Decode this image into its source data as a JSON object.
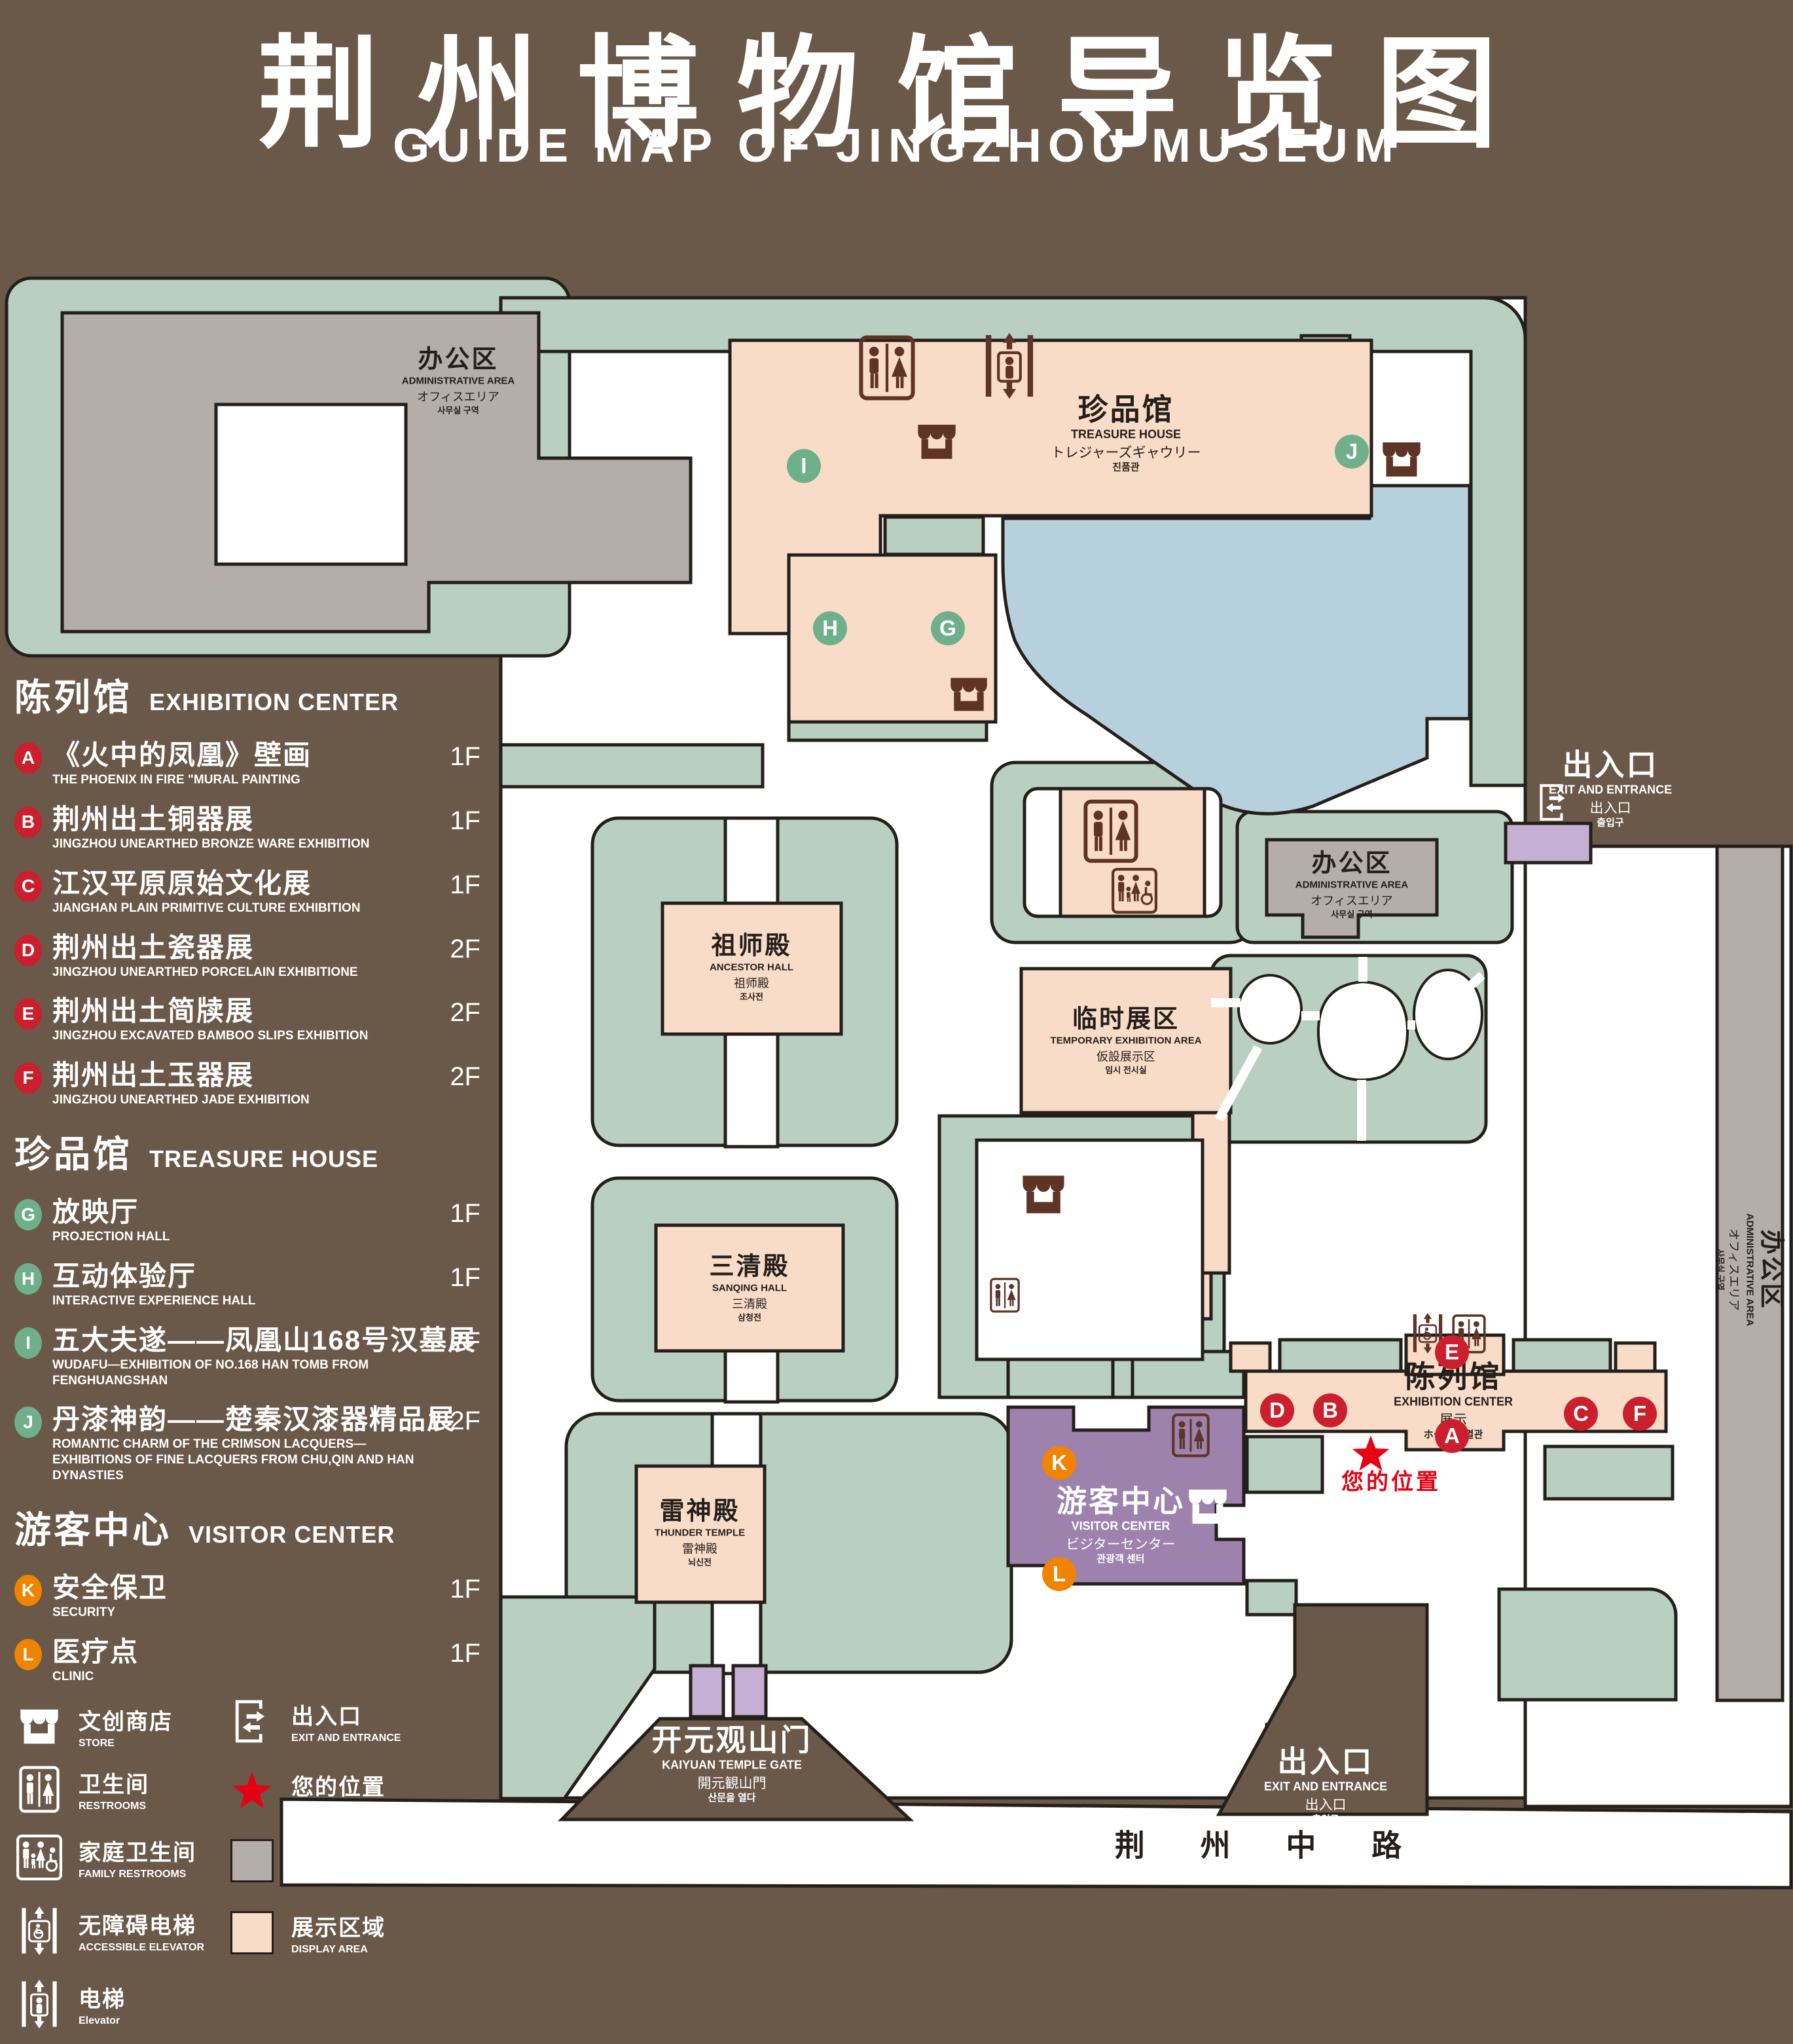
{
  "title": {
    "zh": "荆州博物馆导览图",
    "en": "GUIDE MAP OF JINGZHOU MUSEUM"
  },
  "legend": {
    "sections": [
      {
        "zh": "陈列馆",
        "en": "EXHIBITION CENTER",
        "color": "#cc1f2d",
        "items": [
          {
            "key": "A",
            "zh": "《火中的凤凰》壁画",
            "en": "THE PHOENIX IN FIRE \"MURAL PAINTING",
            "floor": "1F"
          },
          {
            "key": "B",
            "zh": "荆州出土铜器展",
            "en": "JINGZHOU UNEARTHED BRONZE WARE EXHIBITION",
            "floor": "1F"
          },
          {
            "key": "C",
            "zh": "江汉平原原始文化展",
            "en": "JIANGHAN PLAIN PRIMITIVE CULTURE EXHIBITION",
            "floor": "1F"
          },
          {
            "key": "D",
            "zh": "荆州出土瓷器展",
            "en": "JINGZHOU UNEARTHED PORCELAIN EXHIBITIONE",
            "floor": "2F"
          },
          {
            "key": "E",
            "zh": "荆州出土简牍展",
            "en": "JINGZHOU EXCAVATED BAMBOO SLIPS EXHIBITION",
            "floor": "2F"
          },
          {
            "key": "F",
            "zh": "荆州出土玉器展",
            "en": "JINGZHOU UNEARTHED JADE EXHIBITION",
            "floor": "2F"
          }
        ]
      },
      {
        "zh": "珍品馆",
        "en": "TREASURE HOUSE",
        "color": "#6fb08a",
        "items": [
          {
            "key": "G",
            "zh": "放映厅",
            "en": "PROJECTION HALL",
            "floor": "1F"
          },
          {
            "key": "H",
            "zh": "互动体验厅",
            "en": "INTERACTIVE EXPERIENCE HALL",
            "floor": "1F"
          },
          {
            "key": "I",
            "zh": "五大夫遂——凤凰山168号汉墓展",
            "en": "WUDAFU—EXHIBITION OF NO.168 HAN TOMB FROM FENGHUANGSHAN",
            "floor": "2F"
          },
          {
            "key": "J",
            "zh": "丹漆神韵——楚秦汉漆器精品展",
            "en": "ROMANTIC CHARM OF THE CRIMSON LACQUERS—EXHIBITIONS OF FINE LACQUERS FROM CHU,QIN AND HAN DYNASTIES",
            "floor": "1-2F"
          }
        ]
      },
      {
        "zh": "游客中心",
        "en": "VISITOR CENTER",
        "color": "#f08300",
        "items": [
          {
            "key": "K",
            "zh": "安全保卫",
            "en": "SECURITY",
            "floor": "1F"
          },
          {
            "key": "L",
            "zh": "医疗点",
            "en": "CLINIC",
            "floor": "1F"
          }
        ]
      }
    ],
    "symbols": [
      {
        "icon": "store-icon",
        "zh": "文创商店",
        "en": "STORE"
      },
      {
        "icon": "exit-icon",
        "zh": "出入口",
        "en": "EXIT AND ENTRANCE"
      },
      {
        "icon": "restroom-icon",
        "zh": "卫生间",
        "en": "RESTROOMS"
      },
      {
        "icon": "location-star-icon",
        "zh": "您的位置",
        "en": "YOUR LOCATION"
      },
      {
        "icon": "family-restroom-icon",
        "zh": "家庭卫生间",
        "en": "FAMILY RESTROOMS"
      },
      {
        "icon": "office-swatch",
        "zh": "办公区域",
        "en": "OFFICE AREA"
      },
      {
        "icon": "accessible-elevator-icon",
        "zh": "无障碍电梯",
        "en": "ACCESSIBLE ELEVATOR"
      },
      {
        "icon": "display-swatch",
        "zh": "展示区域",
        "en": "DISPLAY AREA"
      },
      {
        "icon": "elevator-icon",
        "zh": "电梯",
        "en": "Elevator"
      }
    ]
  },
  "map": {
    "labels": {
      "admin": {
        "zh": "办公区",
        "en": "ADMINISTRATIVE AREA",
        "jp": "オフィスエリア",
        "kr": "사무실 구역"
      },
      "treasure": {
        "zh": "珍品馆",
        "en": "TREASURE HOUSE",
        "jp": "トレジャーズギャウリー",
        "kr": "진품관"
      },
      "ancestor": {
        "zh": "祖师殿",
        "en": "ANCESTOR HALL",
        "jp": "祖师殿",
        "kr": "조사전"
      },
      "sanqing": {
        "zh": "三清殿",
        "en": "SANQING HALL",
        "jp": "三清殿",
        "kr": "삼청전"
      },
      "temporary": {
        "zh": "临时展区",
        "en": "TEMPORARY EXHIBITION AREA",
        "jp": "仮設展示区",
        "kr": "임시 전시실"
      },
      "thunder": {
        "zh": "雷神殿",
        "en": "THUNDER TEMPLE",
        "jp": "雷神殿",
        "kr": "뇌신전"
      },
      "visitor": {
        "zh": "游客中心",
        "en": "VISITOR CENTER",
        "jp": "ビジターセンター",
        "kr": "관광객 센터"
      },
      "exhibition": {
        "zh": "陈列馆",
        "en": "EXHIBITION CENTER",
        "jp": "展示",
        "kr": "ホール 진열관"
      },
      "gate": {
        "zh": "开元观山门",
        "en": "KAIYUAN TEMPLE GATE",
        "jp": "開元観山門",
        "kr": "산문을 열다"
      },
      "exit": {
        "zh": "出入口",
        "en": "EXIT AND ENTRANCE",
        "jp": "出入口",
        "kr": "출입구"
      },
      "road": "荆 州 中 路",
      "your_location": "您的位置"
    },
    "markers": {
      "A": "A",
      "B": "B",
      "C": "C",
      "D": "D",
      "E": "E",
      "F": "F",
      "G": "G",
      "H": "H",
      "I": "I",
      "J": "J",
      "K": "K",
      "L": "L"
    }
  },
  "colors": {
    "background": "#6a5849",
    "lawn": "#b8cfc1",
    "display_area": "#f9dcc8",
    "office_area": "#b4adaa",
    "lake": "#b7d0dd",
    "visitor_center": "#9d82ae",
    "gate_purple": "#c5b0d4",
    "outline": "#241f1b",
    "icon_brown": "#5e3425",
    "marker_red": "#cc1f2d",
    "marker_green": "#6fb08a",
    "marker_orange": "#f08300",
    "location_red": "#e60012"
  }
}
